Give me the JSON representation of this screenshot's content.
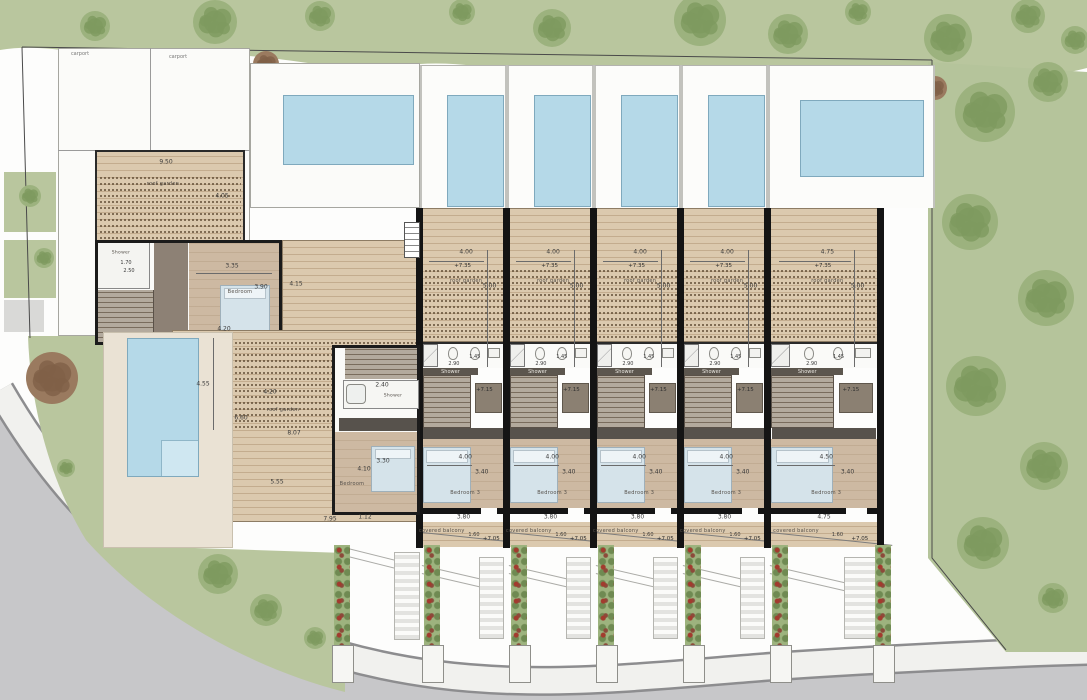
{
  "site": {
    "carport_1": "carport",
    "carport_2": "carport"
  },
  "colors": {
    "grass": "#b9c69e",
    "road": "#c7c7c9",
    "pool": "#b5d9e8",
    "deck_wood": "#dbc9ae",
    "interior_floor": "#cdb9a2",
    "wall": "#141414"
  },
  "left_house": {
    "upper_roof_garden": {
      "label": "roof garden",
      "width": "9.50",
      "depth": "4.05"
    },
    "shower_room": {
      "label": "Shower",
      "width": "1.70",
      "depth": "2.50"
    },
    "bedroom": {
      "label": "Bedroom",
      "width": "3.35",
      "depth": "3.90",
      "width_bottom": "4.20"
    },
    "east_deck": {
      "depth": "4.15"
    },
    "lower_roof_garden": {
      "label": "roof garden",
      "west_depth": "4.55",
      "pergola_width": "4.20",
      "width": "6.60",
      "diag": "8.07",
      "south_width": "5.55"
    },
    "south_dims": {
      "total": "7.95",
      "extra": "1.12"
    },
    "annex": {
      "bath_width": "2.40",
      "shower_label": "Shower",
      "bed_width": "3.30",
      "bed_depth": "4.10",
      "bedroom_label": "Bedroom"
    }
  },
  "units": [
    {
      "id": "unit-1",
      "terrace_width": "4.00",
      "roof_level": "+7.35",
      "roof_garden_label": "roof garden",
      "roof_depth": "5.00",
      "bath_width": "2.90",
      "shower_width": "1.45",
      "shower_label": "Shower",
      "stair_level": "+7.15",
      "bed_width": "4.00",
      "bed_depth": "3.40",
      "bedroom_label": "Bedroom 3",
      "rear_width": "3.80",
      "balcony_label": "covered balcony",
      "balcony_depth": "1.60",
      "balcony_level": "+7.05"
    },
    {
      "id": "unit-2",
      "terrace_width": "4.00",
      "roof_level": "+7.35",
      "roof_garden_label": "roof garden",
      "roof_depth": "5.00",
      "bath_width": "2.90",
      "shower_width": "1.45",
      "shower_label": "Shower",
      "stair_level": "+7.15",
      "bed_width": "4.00",
      "bed_depth": "3.40",
      "bedroom_label": "Bedroom 3",
      "rear_width": "3.80",
      "balcony_label": "covered balcony",
      "balcony_depth": "1.60",
      "balcony_level": "+7.05"
    },
    {
      "id": "unit-3",
      "terrace_width": "4.00",
      "roof_level": "+7.35",
      "roof_garden_label": "roof garden",
      "roof_depth": "5.00",
      "bath_width": "2.90",
      "shower_width": "1.45",
      "shower_label": "Shower",
      "stair_level": "+7.15",
      "bed_width": "4.00",
      "bed_depth": "3.40",
      "bedroom_label": "Bedroom 3",
      "rear_width": "3.80",
      "balcony_label": "covered balcony",
      "balcony_depth": "1.60",
      "balcony_level": "+7.05"
    },
    {
      "id": "unit-4",
      "terrace_width": "4.00",
      "roof_level": "+7.35",
      "roof_garden_label": "roof garden",
      "roof_depth": "5.00",
      "bath_width": "2.90",
      "shower_width": "1.45",
      "shower_label": "Shower",
      "stair_level": "+7.15",
      "bed_width": "4.00",
      "bed_depth": "3.40",
      "bedroom_label": "Bedroom 3",
      "rear_width": "3.80",
      "balcony_label": "covered balcony",
      "balcony_depth": "1.60",
      "balcony_level": "+7.05"
    },
    {
      "id": "unit-5",
      "terrace_width": "4.75",
      "roof_level": "+7.35",
      "roof_garden_label": "roof garden",
      "roof_depth": "5.00",
      "bath_width": "2.90",
      "shower_width": "1.45",
      "shower_label": "Shower",
      "stair_level": "+7.15",
      "bed_width": "4.50",
      "bed_depth": "3.40",
      "bedroom_label": "Bedroom 3",
      "rear_width": "4.75",
      "balcony_label": "covered balcony",
      "balcony_depth": "1.60",
      "balcony_level": "+7.05"
    }
  ]
}
